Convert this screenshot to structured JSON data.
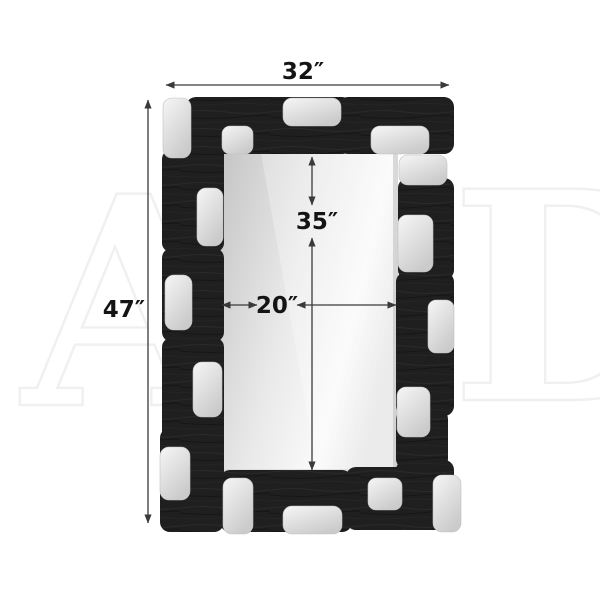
{
  "dimensions": {
    "overall_width": {
      "label": "32″"
    },
    "overall_height": {
      "label": "47″"
    },
    "mirror_height": {
      "label": "35″"
    },
    "mirror_width": {
      "label": "20″"
    }
  },
  "watermark": {
    "letters": [
      "A",
      "D"
    ]
  },
  "colors": {
    "background": "#ffffff",
    "frame_black": "#1f1f1f",
    "frame_grain_light": "#2d2d2d",
    "frame_grain_dark": "#141414",
    "silver_light": "#f6f6f6",
    "silver_dark": "#cbcbcb",
    "mirror_dark": "#c7c7c7",
    "mirror_mid": "#e9e9e9",
    "mirror_light": "#fafafa",
    "mirror_edge": "#e3e3e3",
    "dimension_line": "#3a3a3a",
    "label_text": "#141414",
    "watermark_gray": "#eeeeee"
  }
}
